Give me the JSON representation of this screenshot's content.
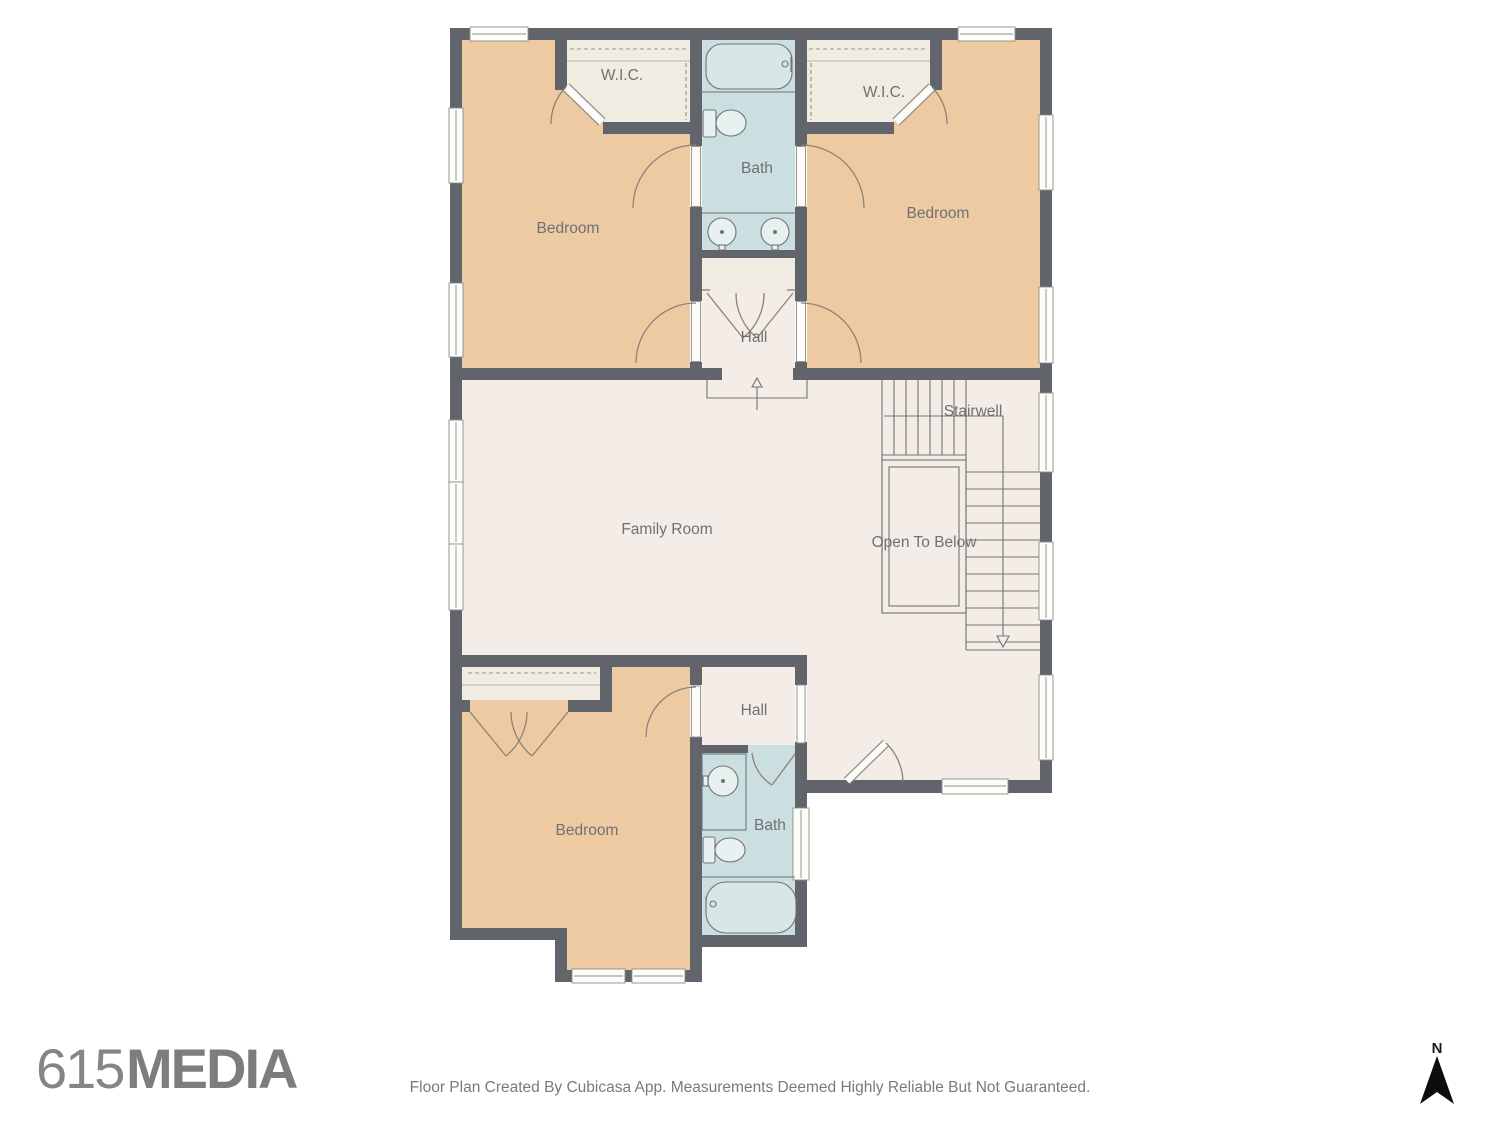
{
  "floor_plan": {
    "rooms": {
      "bedroom_top_left": "Bedroom",
      "bedroom_top_right": "Bedroom",
      "bedroom_bottom": "Bedroom",
      "wic_left": "W.I.C.",
      "wic_right": "W.I.C.",
      "bath_top": "Bath",
      "bath_bottom": "Bath",
      "hall_top": "Hall",
      "hall_bottom": "Hall",
      "family_room": "Family Room",
      "stairwell": "Stairwell",
      "open_to_below": "Open To Below"
    },
    "colors": {
      "wall": "#61656b",
      "room_cream": "#f4ede7",
      "room_tan": "#eecaa3",
      "room_bath_blue": "#cbdfe0",
      "closet_fill": "#f1ece2",
      "label_text": "#6d7175"
    }
  },
  "branding": {
    "logo_number": "615",
    "logo_word": "MEDIA"
  },
  "footer": {
    "disclaimer": "Floor Plan Created By Cubicasa App. Measurements Deemed Highly Reliable But Not Guaranteed."
  },
  "compass": {
    "north_label": "N"
  }
}
